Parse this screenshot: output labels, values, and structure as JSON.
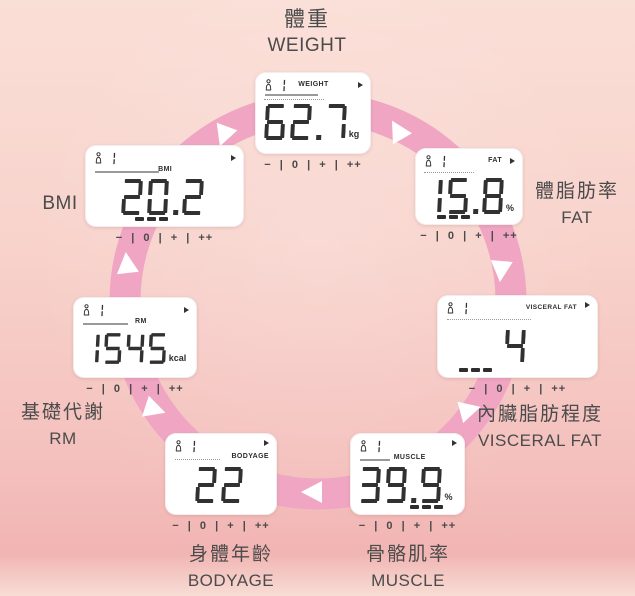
{
  "panels": [
    {
      "id": "weight",
      "label_zh": "體重",
      "label_en": "WEIGHT",
      "lcd_label": "WEIGHT",
      "user": "1",
      "value": "62.7",
      "unit": "kg",
      "scale": "− | 0 | + | ++"
    },
    {
      "id": "fat",
      "label_zh": "體脂肪率",
      "label_en": "FAT",
      "lcd_label": "FAT",
      "user": "1",
      "value": "15.8",
      "unit": "%",
      "scale": "− | 0 | + | ++"
    },
    {
      "id": "visceral-fat",
      "label_zh": "內臟脂肪程度",
      "label_en": "VISCERAL FAT",
      "lcd_label": "VISCERAL FAT",
      "user": "1",
      "value": "4",
      "unit": "",
      "scale": "− | 0 | + | ++"
    },
    {
      "id": "muscle",
      "label_zh": "骨骼肌率",
      "label_en": "MUSCLE",
      "lcd_label": "MUSCLE",
      "user": "1",
      "value": "39.9",
      "unit": "%",
      "scale": "− | 0 | + | ++"
    },
    {
      "id": "bodyage",
      "label_zh": "身體年齡",
      "label_en": "BODYAGE",
      "lcd_label": "BODYAGE",
      "user": "1",
      "value": "22",
      "unit": "",
      "scale": "− | 0 | + | ++"
    },
    {
      "id": "rm",
      "label_zh": "基礎代謝",
      "label_en": "RM",
      "lcd_label": "RM",
      "user": "1",
      "value": "1545",
      "unit": "kcal",
      "scale": "− | 0 | + | ++"
    },
    {
      "id": "bmi",
      "label_zh": "",
      "label_en": "BMI",
      "lcd_label": "BMI",
      "user": "1",
      "value": "20.2",
      "unit": "",
      "scale": "− | 0 | + | ++"
    }
  ],
  "colors": {
    "background_top": "#fadfd7",
    "background_bottom": "#f1b5b3",
    "band": "#f0a6c3",
    "arrow": "#ffffff",
    "digit": "#313131",
    "label_text": "#4b4b4b"
  }
}
